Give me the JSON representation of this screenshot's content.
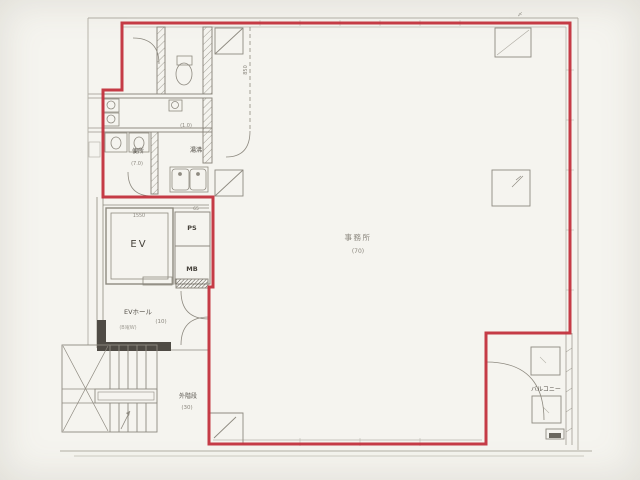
{
  "document": {
    "kind": "architectural-floor-plan",
    "style": "scanned blueprint, red lease-boundary outline on grey linework"
  },
  "labels": {
    "office": "事務所",
    "office_area": "(70)",
    "ev": "EV",
    "ps": "PS",
    "mb": "MB",
    "ev_hall": "EVホール",
    "ev_hall_area": "(10)",
    "ev_hall_note": "(B電W)",
    "toilet": "便所",
    "toilet_area": "(7.0)",
    "hot_water": "湯沸",
    "small_room_area": "(1.0)",
    "balcony": "バルコニー",
    "outer_stair": "外階段",
    "outer_stair_area": "(30)",
    "dim_1550": "1550",
    "dim_65": "65",
    "dim_850": "850",
    "corner_mark": "〆"
  },
  "colors": {
    "outline_red": "#c2303c",
    "paper": "#f5f4ef",
    "line_grey": "#8e8a80",
    "wall_dark": "#4f4b45",
    "text_grey": "#55514a"
  }
}
